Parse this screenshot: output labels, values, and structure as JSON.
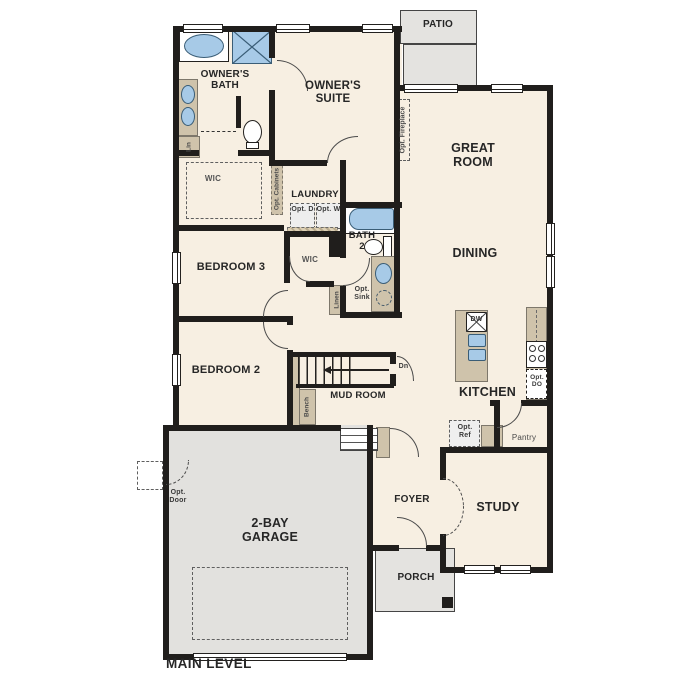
{
  "title": "MAIN LEVEL",
  "colors": {
    "floor": "#f7efe2",
    "wall": "#201e1c",
    "fixture_blue": "#a7cae7",
    "cabinet_tan": "#cfc3ab",
    "outdoor_gray": "#e4e3e0"
  },
  "rooms": {
    "patio": "PATIO",
    "owners_bath": "OWNER'S BATH",
    "owners_suite": "OWNER'S SUITE",
    "great_room": "GREAT ROOM",
    "wic_owner": "WIC",
    "laundry": "LAUNDRY",
    "bath2": "BATH 2",
    "wic_hall": "WIC",
    "bedroom3": "BEDROOM 3",
    "dining": "DINING",
    "bedroom2": "BEDROOM 2",
    "mud_room": "MUD ROOM",
    "kitchen": "KITCHEN",
    "pantry": "Pantry",
    "garage": "2-BAY GARAGE",
    "foyer": "FOYER",
    "study": "STUDY",
    "porch": "PORCH"
  },
  "annotations": {
    "lin": "Lin",
    "opt_cabinets": "Opt. Cabinets",
    "opt_d": "Opt. D",
    "opt_w": "Opt. W",
    "opt_fireplace": "Opt. Fireplace",
    "linen": "Linen",
    "opt_sink": "Opt. Sink",
    "bench": "Bench",
    "dn": "Dn",
    "dw": "DW",
    "opt_do": "Opt. DO",
    "opt_ref": "Opt. Ref",
    "opt_door": "Opt. Door"
  }
}
